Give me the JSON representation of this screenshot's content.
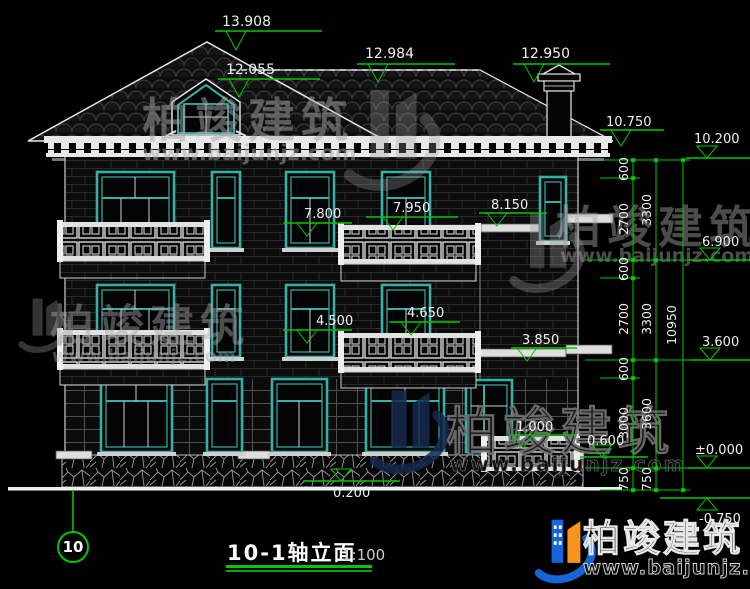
{
  "title_block": {
    "title": "10-1轴立面",
    "scale": "1:100"
  },
  "axis": {
    "label": "10"
  },
  "elevation_markers": {
    "ridge": "13.908",
    "dormer": "12.055",
    "ridge_main": "12.984",
    "chimney": "12.950",
    "eave": "10.750",
    "parapet": "10.200",
    "f3_left": "7.800",
    "f3_mid": "7.950",
    "f3_right": "8.150",
    "f2_left": "4.500",
    "f2_mid": "4.650",
    "f2_right": "3.850",
    "level_69": "6.900",
    "level_36": "3.600",
    "level_zero": "±0.000",
    "level_neg": "-0.750",
    "porch": "1.000",
    "terrace": "0.600",
    "ground": "0.200"
  },
  "dimension_chains": {
    "inner": [
      "600",
      "2700",
      "600",
      "2700",
      "600",
      "3000",
      "750"
    ],
    "middle": [
      "3300",
      "3300",
      "3600",
      "750"
    ],
    "total": "10950"
  },
  "watermark": {
    "brand": "柏竣建筑",
    "website": "www.baijunjz.com"
  },
  "colors": {
    "background": "#000000",
    "dimension_green": "#00c800",
    "window_teal": "#35b0a8",
    "linework_white": "#e8e8e8",
    "logo_blue": "#1565d8",
    "logo_orange": "#f7941d"
  }
}
